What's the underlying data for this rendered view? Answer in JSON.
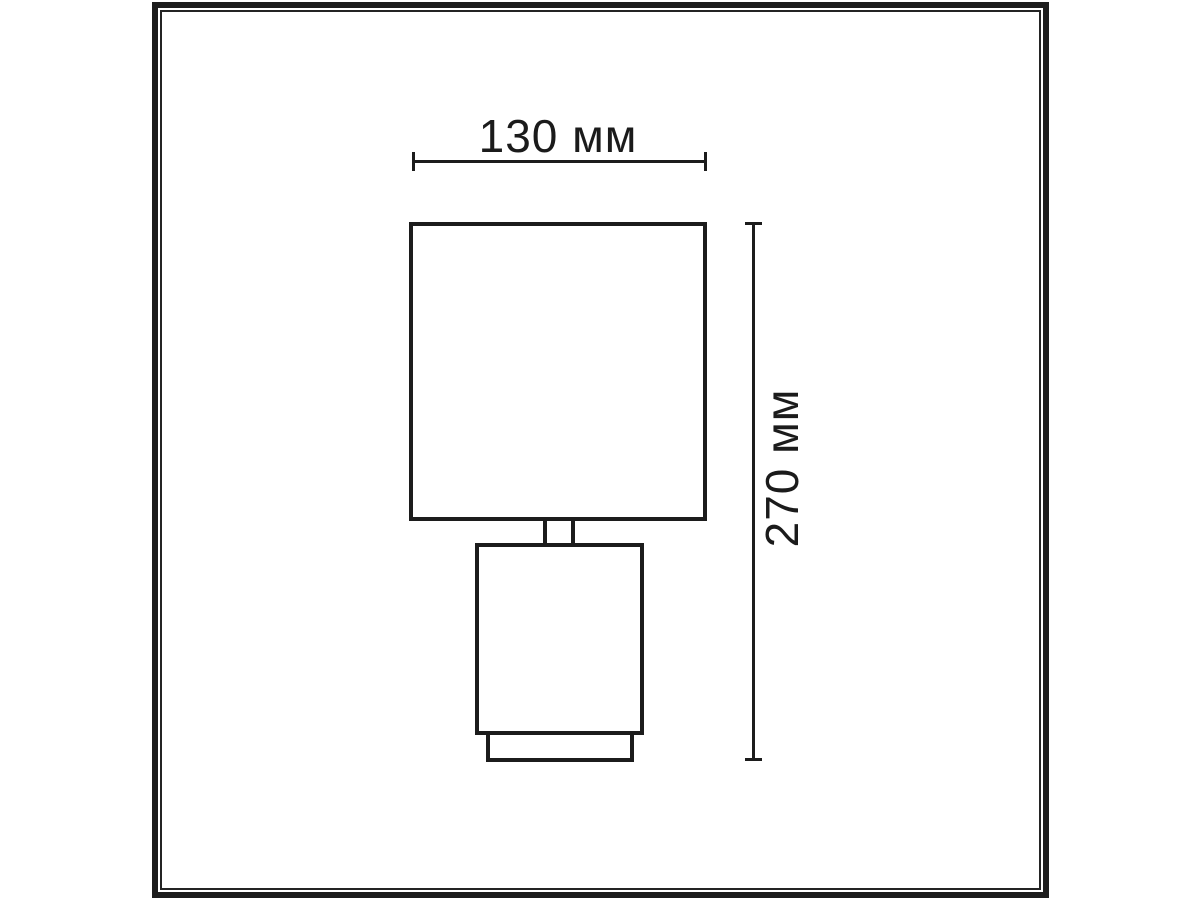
{
  "drawing": {
    "subject": "table-lamp-front-view-dimension-drawing",
    "width_dimension_label": "130 мм",
    "height_dimension_label": "270 мм",
    "stroke_color": "#1c1c1c",
    "background_color": "#ffffff"
  }
}
